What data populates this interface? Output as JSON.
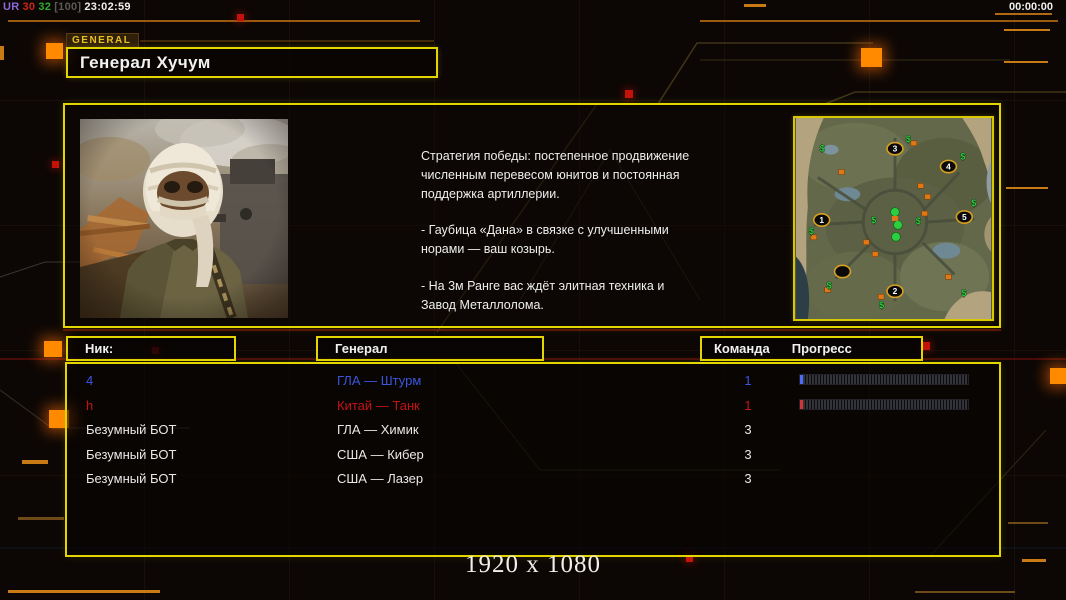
{
  "debug": {
    "segments": [
      {
        "text": "UR",
        "color": "#8a6ad8"
      },
      {
        "text": "30",
        "color": "#cc2418"
      },
      {
        "text": "32",
        "color": "#2eaa2e"
      },
      {
        "text": "[100]",
        "color": "#5a5a5a"
      },
      {
        "text": "23:02:59",
        "color": "#f0f0f0"
      }
    ]
  },
  "timer": "00:00:00",
  "header": {
    "tag": "GENERAL",
    "title": "Генерал Хучум"
  },
  "briefing": {
    "paragraphs": [
      "Стратегия победы: постепенное продвижение численным перевесом юнитов и постоянная поддержка артиллерии.",
      "- Гаубица «Дана» в связке с улучшенными норами — ваш козырь.",
      "- На 3м Ранге вас ждёт элитная техника и Завод Металлолома."
    ]
  },
  "map": {
    "money_symbol": "$",
    "positions": [
      {
        "n": "1",
        "x": 26,
        "y": 103
      },
      {
        "n": "2",
        "x": 100,
        "y": 175
      },
      {
        "n": "3",
        "x": 100,
        "y": 31
      },
      {
        "n": "4",
        "x": 154,
        "y": 49
      },
      {
        "n": "5",
        "x": 170,
        "y": 100
      }
    ],
    "empty_slot": {
      "x": 47,
      "y": 155
    },
    "money_markers": [
      [
        27,
        31
      ],
      [
        114,
        21
      ],
      [
        169,
        39
      ],
      [
        180,
        86
      ],
      [
        79,
        103
      ],
      [
        124,
        104
      ],
      [
        16,
        114
      ],
      [
        34,
        169
      ],
      [
        87,
        189
      ],
      [
        170,
        177
      ]
    ],
    "supply_markers": [
      [
        46,
        54
      ],
      [
        126,
        68
      ],
      [
        133,
        79
      ],
      [
        130,
        96
      ],
      [
        18,
        120
      ],
      [
        71,
        125
      ],
      [
        80,
        137
      ],
      [
        32,
        173
      ],
      [
        86,
        180
      ],
      [
        119,
        25
      ],
      [
        154,
        160
      ]
    ],
    "center_cluster": [
      [
        100,
        95
      ],
      [
        103,
        108
      ],
      [
        101,
        120
      ]
    ]
  },
  "table": {
    "headers": {
      "nick": "Ник:",
      "general": "Генерал",
      "team": "Команда",
      "progress": "Прогресс"
    },
    "rows": [
      {
        "nick": "4",
        "general": "ГЛА — Штурм",
        "team": "1",
        "color": "#3c55e0",
        "has_bar": true,
        "bar_color": "#4a6cff"
      },
      {
        "nick": "h",
        "general": "Китай — Танк",
        "team": "1",
        "color": "#c41414",
        "has_bar": true,
        "bar_color": "#d03434"
      },
      {
        "nick": "Безумный БОТ",
        "general": "ГЛА — Химик",
        "team": "3",
        "color": "#e8e8e8",
        "has_bar": false
      },
      {
        "nick": "Безумный БОТ",
        "general": "США — Кибер",
        "team": "3",
        "color": "#e8e8e8",
        "has_bar": false
      },
      {
        "nick": "Безумный БОТ",
        "general": "США — Лазер",
        "team": "3",
        "color": "#e8e8e8",
        "has_bar": false
      }
    ]
  },
  "footer": {
    "resolution": "1920 x 1080"
  },
  "colors": {
    "accent_yellow": "#e3d600",
    "accent_orange": "#ff8a00",
    "player_blue": "#3c55e0",
    "player_red": "#c41414",
    "map_money_green": "#2ecc40",
    "map_supply_orange": "#e07818",
    "map_ring_gold": "#d8a020"
  }
}
